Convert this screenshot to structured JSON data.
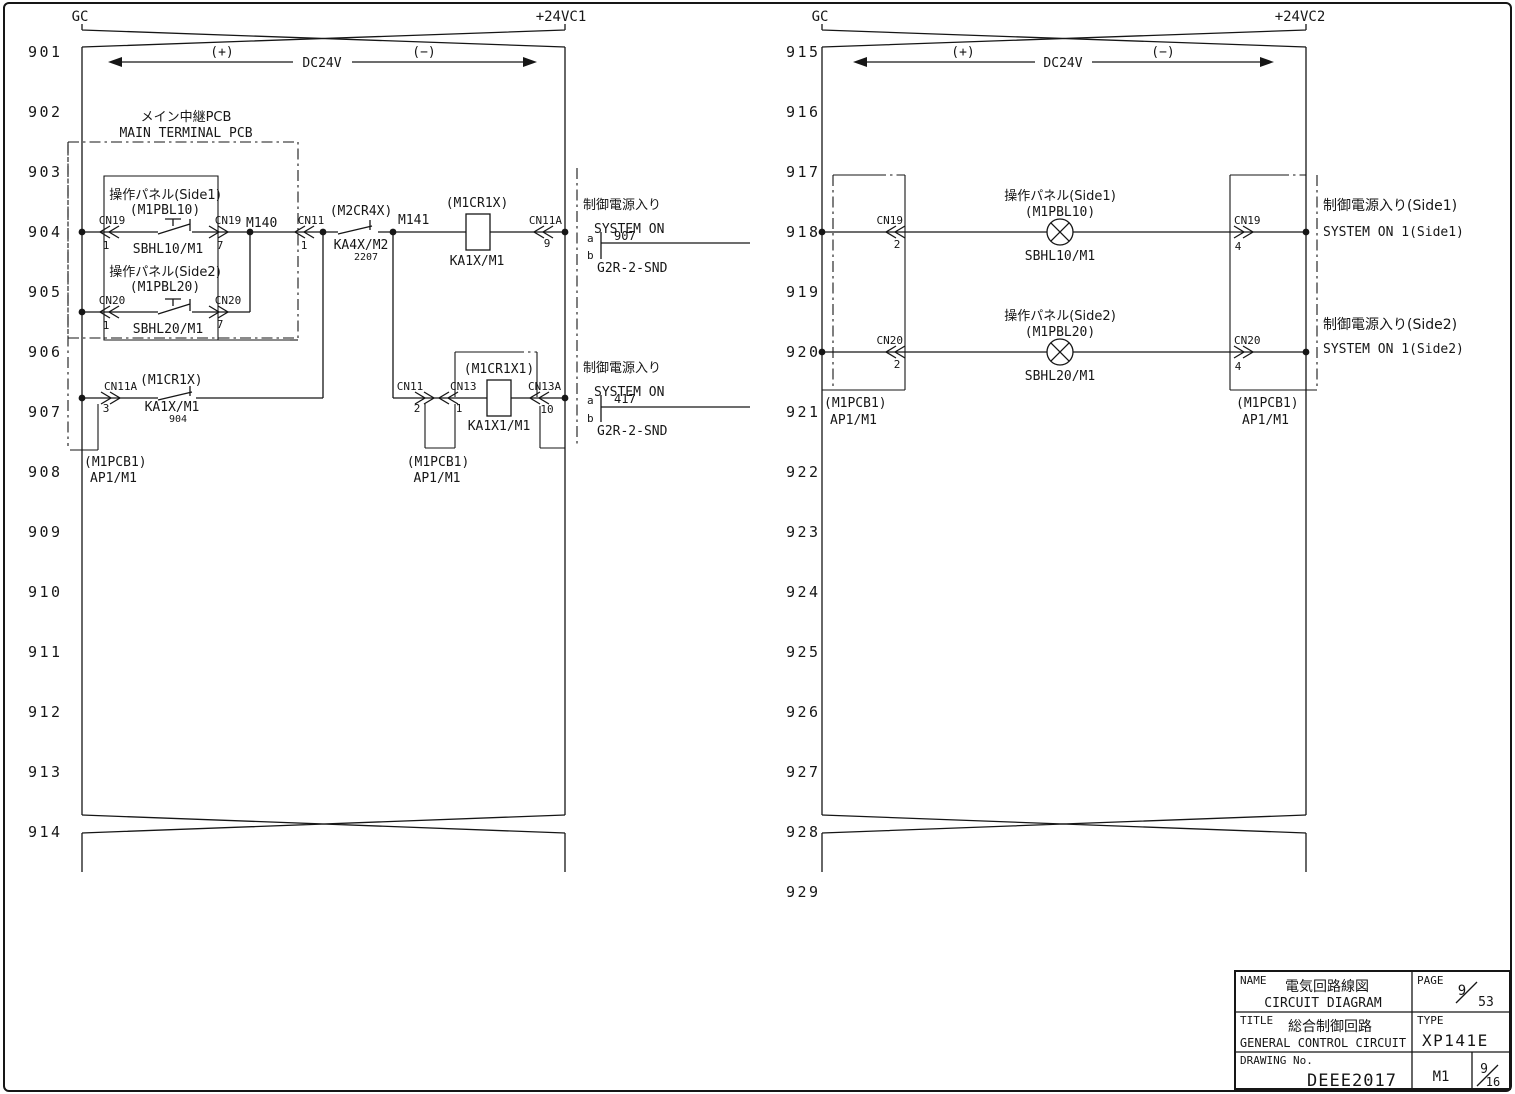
{
  "left": {
    "bus": {
      "gc": "GC",
      "vcc": "+24VC1",
      "plus": "(+)",
      "minus": "(−)",
      "volt": "DC24V"
    },
    "line_numbers": [
      "901",
      "902",
      "903",
      "904",
      "905",
      "906",
      "907",
      "908",
      "909",
      "910",
      "911",
      "912",
      "913",
      "914"
    ],
    "pcb": {
      "jp": "メイン中継PCB",
      "en": "MAIN TERMINAL PCB"
    },
    "sw1": {
      "jp": "操作パネル(Side1)",
      "id": "(M1PBL10)",
      "name": "SBHL10/M1",
      "conn": "CN19",
      "pin_in": "1",
      "pin_out": "7"
    },
    "sw2": {
      "jp": "操作パネル(Side2)",
      "id": "(M1PBL20)",
      "name": "SBHL20/M1",
      "conn": "CN20",
      "pin_in": "1",
      "pin_out": "7"
    },
    "m140": "M140",
    "m141": "M141",
    "cn11": {
      "label": "CN11",
      "pin": "1"
    },
    "ka4x": {
      "id": "(M2CR4X)",
      "name": "KA4X/M2",
      "ref": "2207"
    },
    "coil1": {
      "id": "(M1CR1X)",
      "name": "KA1X/M1"
    },
    "cn11a9": {
      "label": "CN11A",
      "pin": "9"
    },
    "sys1": {
      "jp": "制御電源入り",
      "en": "SYSTEM ON",
      "a": "a",
      "b": "b",
      "ref": "907",
      "part": "G2R-2-SND"
    },
    "cn11a3": {
      "label": "CN11A",
      "pin": "3"
    },
    "hold": {
      "id": "(M1CR1X)",
      "name": "KA1X/M1",
      "ref": "904"
    },
    "cn11_2": {
      "label": "CN11",
      "pin": "2"
    },
    "cn13_1": {
      "label": "CN13",
      "pin": "1"
    },
    "coil2": {
      "id": "(M1CR1X1)",
      "name": "KA1X1/M1"
    },
    "cn13a": {
      "label": "CN13A",
      "pin": "10"
    },
    "sys2": {
      "jp": "制御電源入り",
      "en": "SYSTEM ON",
      "a": "a",
      "b": "b",
      "ref": "417",
      "part": "G2R-2-SND"
    },
    "pcb_left": {
      "id": "(M1PCB1)",
      "name": "AP1/M1"
    },
    "pcb_mid": {
      "id": "(M1PCB1)",
      "name": "AP1/M1"
    }
  },
  "right": {
    "bus": {
      "gc": "GC",
      "vcc": "+24VC2",
      "plus": "(+)",
      "minus": "(−)",
      "volt": "DC24V"
    },
    "line_numbers": [
      "915",
      "916",
      "917",
      "918",
      "919",
      "920",
      "921",
      "922",
      "923",
      "924",
      "925",
      "926",
      "927",
      "928",
      "929"
    ],
    "lamp1": {
      "jp": "操作パネル(Side1)",
      "id": "(M1PBL10)",
      "name": "SBHL10/M1",
      "conn": "CN19",
      "pin_in": "2",
      "pin_out": "4",
      "out_jp": "制御電源入り(Side1)",
      "out_en": "SYSTEM ON 1(Side1)"
    },
    "lamp2": {
      "jp": "操作パネル(Side2)",
      "id": "(M1PBL20)",
      "name": "SBHL20/M1",
      "conn": "CN20",
      "pin_in": "2",
      "pin_out": "4",
      "out_jp": "制御電源入り(Side2)",
      "out_en": "SYSTEM ON 1(Side2)"
    },
    "pcb_left": {
      "id": "(M1PCB1)",
      "name": "AP1/M1"
    },
    "pcb_right": {
      "id": "(M1PCB1)",
      "name": "AP1/M1"
    }
  },
  "title_block": {
    "name_label": "NAME",
    "name_jp": "電気回路線図",
    "name_en": "CIRCUIT DIAGRAM",
    "page_label": "PAGE",
    "page_num": "9",
    "page_den": "53",
    "title_label": "TITLE",
    "title_jp": "総合制御回路",
    "title_en": "GENERAL CONTROL CIRCUIT",
    "type_label": "TYPE",
    "type_value": "XP141E",
    "drawing_label": "DRAWING No.",
    "drawing_value": "DEEE2017",
    "sheet": "M1",
    "sheet_num": "9",
    "sheet_den": "16"
  }
}
